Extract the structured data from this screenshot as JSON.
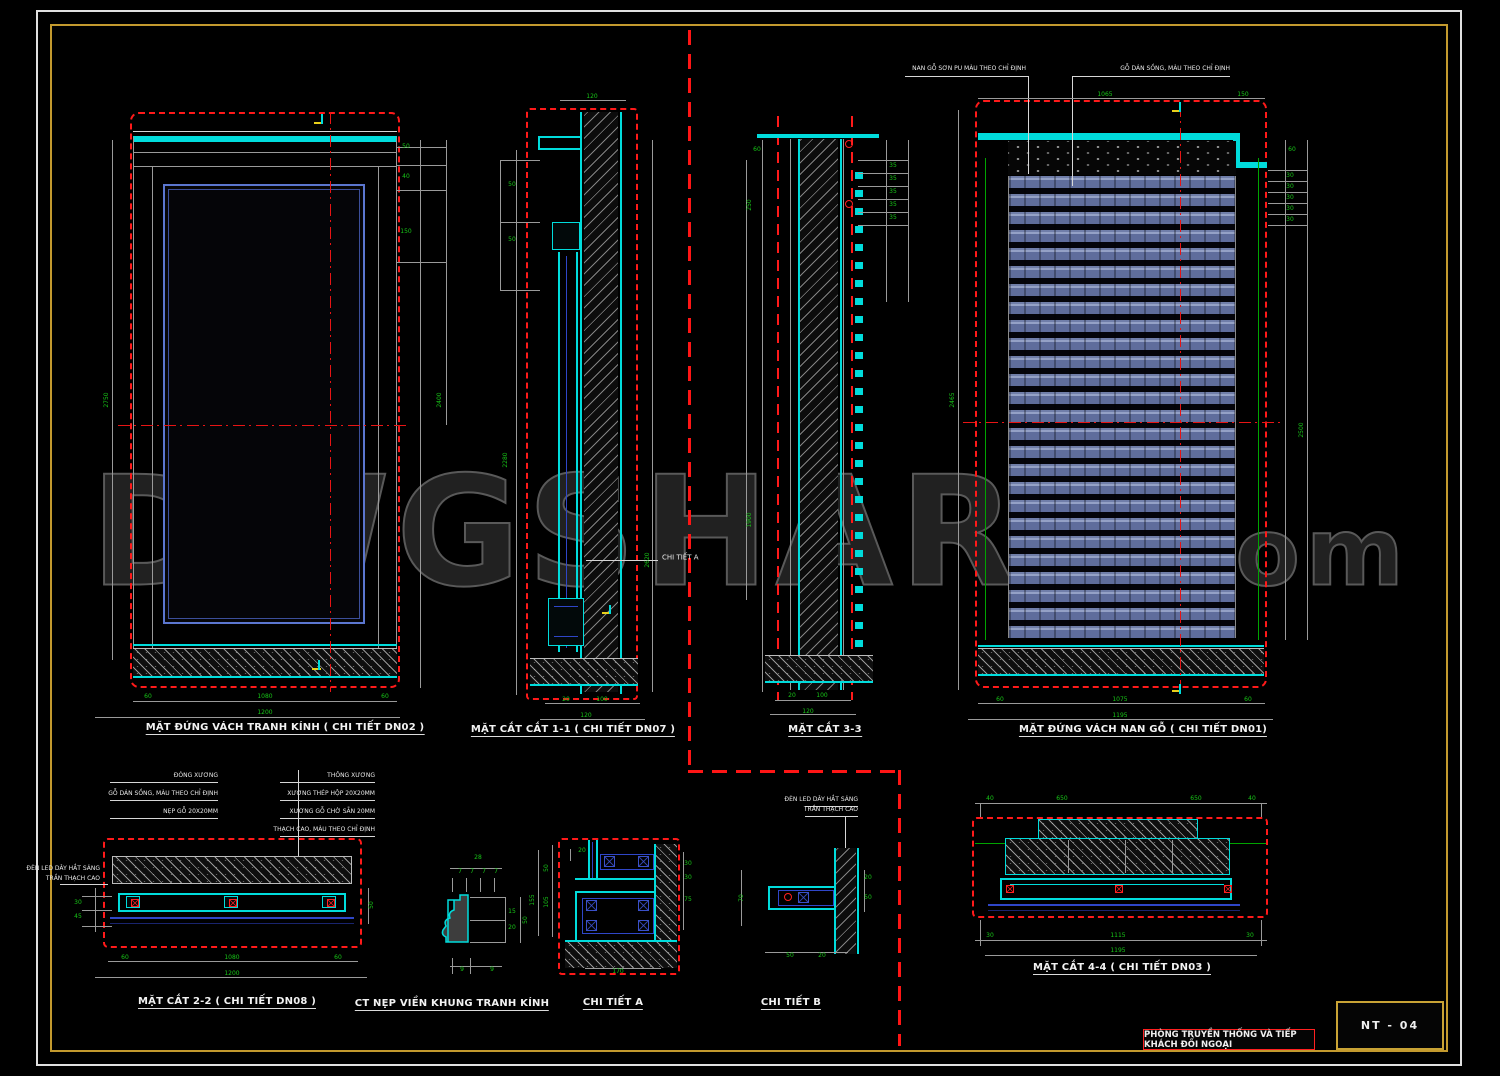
{
  "sheet": {
    "sheet_number": "NT - 04",
    "title_block_text": "PHÒNG TRUYỀN THỐNG VÀ TIẾP KHÁCH ĐỐI NGOẠI",
    "border_outer_color": "#e0e0e0",
    "border_inner_color": "#c39a2e",
    "background": "#000000"
  },
  "watermark": {
    "main": "DWGSHARE",
    "suffix": ".com"
  },
  "colors": {
    "red_dashed": "#ff1a1a",
    "cyan": "#00dcdc",
    "dim_green": "#17c617",
    "frame_blue": "#5b76cf",
    "detail_blue": "#2f46c8",
    "line_gray": "#9a9a9a",
    "hatch_gray": "#aFaFaF",
    "marker_yellow": "#e8cf1a"
  },
  "drawings": {
    "d1": {
      "title": "MẶT ĐỨNG VÁCH TRANH KÍNH ( CHI TIẾT DN02 )"
    },
    "d2": {
      "title": "MẶT CẮT CẮT 1-1 ( CHI TIẾT DN07 )"
    },
    "d3": {
      "title": "MẶT CẮT 3-3"
    },
    "d4": {
      "title": "MẶT ĐỨNG VÁCH NAN GỖ ( CHI TIẾT DN01)"
    },
    "d5": {
      "title": "MẶT CẮT 2-2 ( CHI TIẾT DN08 )"
    },
    "d6": {
      "title": "CT NẸP VIỀN KHUNG TRANH KÍNH"
    },
    "d7": {
      "title": "CHI TIẾT A"
    },
    "d8": {
      "title": "CHI TIẾT B"
    },
    "d9": {
      "title": "MẶT CẮT 4-4 ( CHI TIẾT DN03 )"
    }
  },
  "labels": [
    {
      "t": "60",
      "x": 148,
      "y": 697
    },
    {
      "t": "1080",
      "x": 265,
      "y": 697
    },
    {
      "t": "60",
      "x": 385,
      "y": 697
    },
    {
      "t": "1200",
      "x": 265,
      "y": 713
    },
    {
      "t": "2750",
      "x": 107,
      "y": 400,
      "r": -90
    },
    {
      "t": "50",
      "x": 406,
      "y": 147
    },
    {
      "t": "40",
      "x": 406,
      "y": 177
    },
    {
      "t": "150",
      "x": 406,
      "y": 232
    },
    {
      "t": "2400",
      "x": 440,
      "y": 400,
      "r": -90
    },
    {
      "t": "120",
      "x": 592,
      "y": 97
    },
    {
      "t": "50",
      "x": 512,
      "y": 185
    },
    {
      "t": "50",
      "x": 512,
      "y": 240
    },
    {
      "t": "2280",
      "x": 506,
      "y": 460,
      "r": -90
    },
    {
      "t": "2620",
      "x": 648,
      "y": 560,
      "r": -90
    },
    {
      "t": "20",
      "x": 566,
      "y": 700
    },
    {
      "t": "100",
      "x": 602,
      "y": 700
    },
    {
      "t": "120",
      "x": 586,
      "y": 716
    },
    {
      "t": "CHI TIẾT A",
      "x": 662,
      "y": 558,
      "c": "w",
      "a": "l",
      "s": 7
    },
    {
      "t": "60",
      "x": 757,
      "y": 150
    },
    {
      "t": "250",
      "x": 750,
      "y": 205,
      "r": -90
    },
    {
      "t": "1900",
      "x": 750,
      "y": 520,
      "r": -90
    },
    {
      "t": "35",
      "x": 893,
      "y": 166
    },
    {
      "t": "35",
      "x": 893,
      "y": 179
    },
    {
      "t": "35",
      "x": 893,
      "y": 192
    },
    {
      "t": "35",
      "x": 893,
      "y": 205
    },
    {
      "t": "35",
      "x": 893,
      "y": 218
    },
    {
      "t": "20",
      "x": 792,
      "y": 696
    },
    {
      "t": "100",
      "x": 822,
      "y": 696
    },
    {
      "t": "120",
      "x": 808,
      "y": 712
    },
    {
      "t": "1065",
      "x": 1105,
      "y": 95
    },
    {
      "t": "150",
      "x": 1243,
      "y": 95
    },
    {
      "t": "60",
      "x": 1292,
      "y": 150
    },
    {
      "t": "30",
      "x": 1290,
      "y": 176
    },
    {
      "t": "30",
      "x": 1290,
      "y": 187
    },
    {
      "t": "30",
      "x": 1290,
      "y": 198
    },
    {
      "t": "30",
      "x": 1290,
      "y": 209
    },
    {
      "t": "30",
      "x": 1290,
      "y": 220
    },
    {
      "t": "2465",
      "x": 953,
      "y": 400,
      "r": -90
    },
    {
      "t": "2500",
      "x": 1302,
      "y": 430,
      "r": -90
    },
    {
      "t": "60",
      "x": 1000,
      "y": 700
    },
    {
      "t": "1075",
      "x": 1120,
      "y": 700
    },
    {
      "t": "60",
      "x": 1248,
      "y": 700
    },
    {
      "t": "1195",
      "x": 1120,
      "y": 716
    },
    {
      "t": "NAN GỖ SƠN PU MÀU THEO CHỈ ĐỊNH",
      "x": 1026,
      "y": 69,
      "c": "w",
      "a": "r"
    },
    {
      "t": "GỖ DÁN SỒNG, MÀU THEO CHỈ ĐỊNH",
      "x": 1230,
      "y": 69,
      "c": "w",
      "a": "r"
    },
    {
      "t": "ĐÓNG XƯƠNG",
      "x": 218,
      "y": 776,
      "c": "w",
      "a": "r"
    },
    {
      "t": "GỖ DÁN SỒNG, MÀU THEO CHỈ ĐỊNH",
      "x": 218,
      "y": 794,
      "c": "w",
      "a": "r"
    },
    {
      "t": "NẸP GỖ 20X20MM",
      "x": 218,
      "y": 812,
      "c": "w",
      "a": "r"
    },
    {
      "t": "THÔNG XƯƠNG",
      "x": 375,
      "y": 776,
      "c": "w",
      "a": "r"
    },
    {
      "t": "XƯƠNG THÉP HỘP 20X20MM",
      "x": 375,
      "y": 794,
      "c": "w",
      "a": "r"
    },
    {
      "t": "XƯƠNG GỖ CHỜ SẴN 20MM",
      "x": 375,
      "y": 812,
      "c": "w",
      "a": "r"
    },
    {
      "t": "THẠCH CAO, MÀU THEO CHỈ ĐỊNH",
      "x": 375,
      "y": 830,
      "c": "w",
      "a": "r"
    },
    {
      "t": "ĐÈN LED DÂY HẮT SÁNG",
      "x": 100,
      "y": 869,
      "c": "w",
      "a": "r"
    },
    {
      "t": "TRẦN THẠCH CAO",
      "x": 100,
      "y": 879,
      "c": "w",
      "a": "r"
    },
    {
      "t": "30",
      "x": 78,
      "y": 903
    },
    {
      "t": "45",
      "x": 78,
      "y": 917
    },
    {
      "t": "50",
      "x": 372,
      "y": 905,
      "r": -90
    },
    {
      "t": "60",
      "x": 125,
      "y": 958
    },
    {
      "t": "1080",
      "x": 232,
      "y": 958
    },
    {
      "t": "60",
      "x": 338,
      "y": 958
    },
    {
      "t": "1200",
      "x": 232,
      "y": 974
    },
    {
      "t": "28",
      "x": 478,
      "y": 858
    },
    {
      "t": "7",
      "x": 460,
      "y": 872
    },
    {
      "t": "7",
      "x": 472,
      "y": 872
    },
    {
      "t": "7",
      "x": 484,
      "y": 872
    },
    {
      "t": "7",
      "x": 496,
      "y": 872
    },
    {
      "t": "15",
      "x": 512,
      "y": 912
    },
    {
      "t": "20",
      "x": 512,
      "y": 928
    },
    {
      "t": "50",
      "x": 526,
      "y": 920,
      "r": -90
    },
    {
      "t": "9",
      "x": 462,
      "y": 970
    },
    {
      "t": "9",
      "x": 492,
      "y": 970
    },
    {
      "t": "20",
      "x": 582,
      "y": 851
    },
    {
      "t": "50",
      "x": 547,
      "y": 868,
      "r": -90
    },
    {
      "t": "105",
      "x": 547,
      "y": 902,
      "r": -90
    },
    {
      "t": "155",
      "x": 533,
      "y": 900,
      "r": -90
    },
    {
      "t": "30",
      "x": 688,
      "y": 864
    },
    {
      "t": "30",
      "x": 688,
      "y": 878
    },
    {
      "t": "75",
      "x": 688,
      "y": 900
    },
    {
      "t": "170",
      "x": 618,
      "y": 972
    },
    {
      "t": "ĐÈN LED DÂY HẮT SÁNG",
      "x": 858,
      "y": 800,
      "c": "w",
      "a": "r"
    },
    {
      "t": "TRẦN THẠCH CAO",
      "x": 858,
      "y": 810,
      "c": "w",
      "a": "r"
    },
    {
      "t": "20",
      "x": 868,
      "y": 878
    },
    {
      "t": "50",
      "x": 868,
      "y": 898
    },
    {
      "t": "70",
      "x": 742,
      "y": 898,
      "r": -90
    },
    {
      "t": "50",
      "x": 790,
      "y": 956
    },
    {
      "t": "20",
      "x": 822,
      "y": 956
    },
    {
      "t": "40",
      "x": 990,
      "y": 799
    },
    {
      "t": "650",
      "x": 1062,
      "y": 799
    },
    {
      "t": "650",
      "x": 1196,
      "y": 799
    },
    {
      "t": "40",
      "x": 1252,
      "y": 799
    },
    {
      "t": "30",
      "x": 990,
      "y": 936
    },
    {
      "t": "1115",
      "x": 1118,
      "y": 936
    },
    {
      "t": "30",
      "x": 1250,
      "y": 936
    },
    {
      "t": "1195",
      "x": 1118,
      "y": 951
    }
  ]
}
